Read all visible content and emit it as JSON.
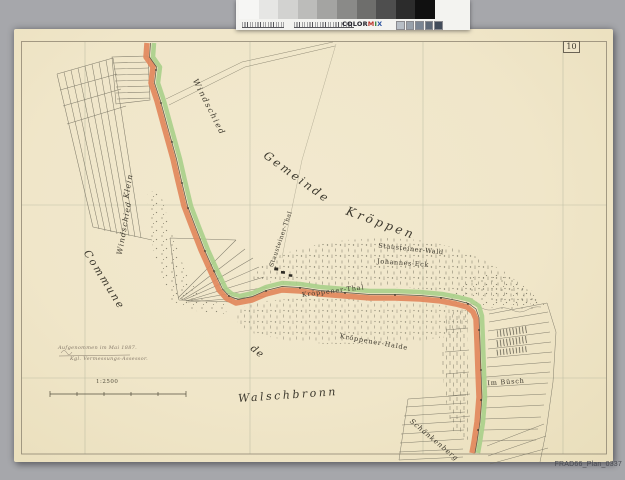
{
  "scan": {
    "scanner_bg": "#a6a7ab",
    "paper_color": "#f0e6c9",
    "archive_ref": "FRAD66_Plan_0337"
  },
  "calibration": {
    "label_letters": [
      {
        "ch": "C",
        "color": "#23232c"
      },
      {
        "ch": "O",
        "color": "#23232c"
      },
      {
        "ch": "L",
        "color": "#23232c"
      },
      {
        "ch": "O",
        "color": "#23232c"
      },
      {
        "ch": "R",
        "color": "#23232c"
      },
      {
        "ch": "M",
        "color": "#b8342a"
      },
      {
        "ch": "I",
        "color": "#2e7d34"
      },
      {
        "ch": "X",
        "color": "#2a52a0"
      }
    ],
    "gray_patches": [
      "#f6f6f4",
      "#e6e6e4",
      "#d2d2d0",
      "#bcbcba",
      "#a4a4a2",
      "#8a8a88",
      "#6e6e6c",
      "#4e4e4e",
      "#2c2c2c",
      "#101010"
    ],
    "color_chips": [
      "#b7bec6",
      "#98a1ab",
      "#7a8593",
      "#5d6877",
      "#414b5a"
    ]
  },
  "map": {
    "sheet_number": "10",
    "frame_color": "#8f8672",
    "boundary_colors": {
      "orange": "#e2885c",
      "green": "#a9cf8a",
      "line": "#55503f"
    },
    "scale": {
      "label": "1:2500"
    },
    "survey_note": {
      "line1": "Aufgenommen im Mai 1887.",
      "line2": "Kgl. Vermessungs-Assessor."
    },
    "labels": [
      {
        "id": "label-windschied",
        "text": "Windschied",
        "x": 209,
        "y": 107,
        "rot": 63,
        "size": 8,
        "ls": 1.5,
        "italic": true
      },
      {
        "id": "label-klein",
        "text": "Klein",
        "x": 128,
        "y": 186,
        "rot": -80,
        "size": 7.5,
        "ls": 1,
        "italic": true
      },
      {
        "id": "label-klein-windschied",
        "text": "Windschied",
        "x": 124,
        "y": 228,
        "rot": -80,
        "size": 7.5,
        "ls": 1,
        "italic": true
      },
      {
        "id": "label-gemeinde",
        "text": "Gemeinde",
        "x": 297,
        "y": 177,
        "rot": 36,
        "size": 11.5,
        "ls": 2.5,
        "italic": true
      },
      {
        "id": "label-kroppen",
        "text": "Kröppen",
        "x": 381,
        "y": 223,
        "rot": 20,
        "size": 12,
        "ls": 3,
        "italic": true
      },
      {
        "id": "label-commune",
        "text": "Commune",
        "x": 104,
        "y": 280,
        "rot": 58,
        "size": 10.5,
        "ls": 2,
        "italic": true
      },
      {
        "id": "label-de",
        "text": "de",
        "x": 257,
        "y": 352,
        "rot": 38,
        "size": 10,
        "ls": 1,
        "italic": true
      },
      {
        "id": "label-walschbronn",
        "text": "Walschbronn",
        "x": 288,
        "y": 395,
        "rot": -4,
        "size": 11,
        "ls": 2.5,
        "italic": true
      },
      {
        "id": "label-stausteiner-wald",
        "text": "Stausteiner-Wald",
        "x": 411,
        "y": 249,
        "rot": 6,
        "size": 6.5,
        "ls": 0.6,
        "italic": false
      },
      {
        "id": "label-johannes-eck",
        "text": "Johannes-Eck",
        "x": 403,
        "y": 263,
        "rot": 4,
        "size": 6.5,
        "ls": 0.6,
        "italic": false
      },
      {
        "id": "label-kroppener-thal",
        "text": "Kröppener-Thal",
        "x": 333,
        "y": 291,
        "rot": -7,
        "size": 6.5,
        "ls": 0.8,
        "italic": false
      },
      {
        "id": "label-stausteiner-thal",
        "text": "Stausteiner-Thal",
        "x": 281,
        "y": 239,
        "rot": -71,
        "size": 6,
        "ls": 0.5,
        "italic": false
      },
      {
        "id": "label-kroppener-halde",
        "text": "Kröppener-Halde",
        "x": 374,
        "y": 342,
        "rot": 10,
        "size": 6.5,
        "ls": 0.8,
        "italic": false
      },
      {
        "id": "label-im-busch",
        "text": "Im Büsch",
        "x": 506,
        "y": 382,
        "rot": -4,
        "size": 6.5,
        "ls": 0.8,
        "italic": false
      },
      {
        "id": "label-schankenberg",
        "text": "Schänkenberg",
        "x": 434,
        "y": 440,
        "rot": 40,
        "size": 7,
        "ls": 0.8,
        "italic": true
      }
    ]
  }
}
